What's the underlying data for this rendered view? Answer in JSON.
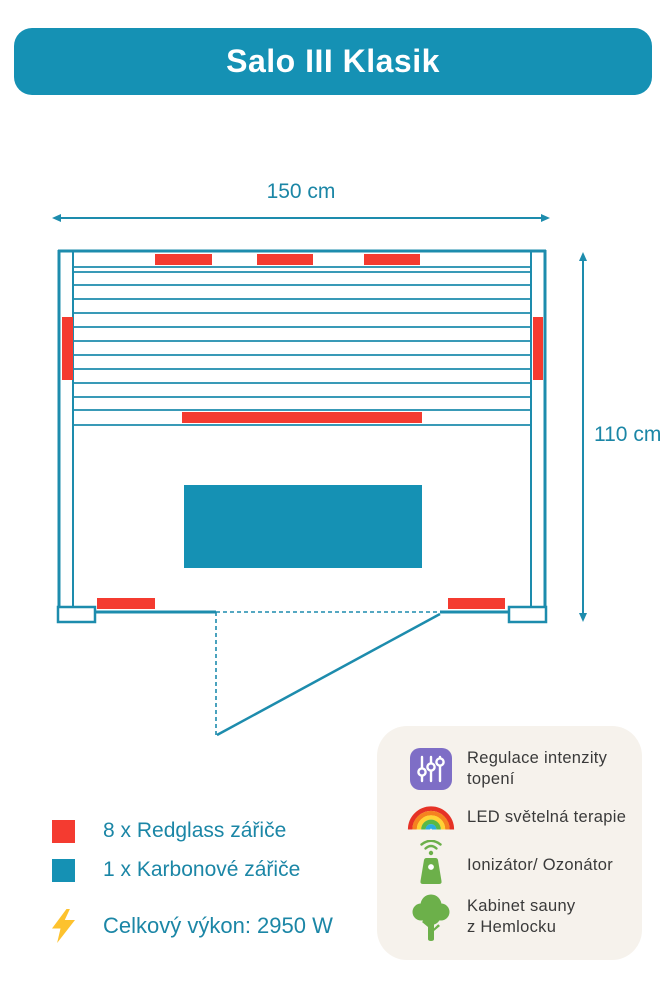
{
  "header": {
    "title": "Salo III Klasik"
  },
  "diagram": {
    "width_label": "150 cm",
    "height_label": "110 cm"
  },
  "legend": {
    "items": [
      {
        "icon": "redglass-swatch",
        "color_key": "red",
        "label": "8 x Redglass zářiče"
      },
      {
        "icon": "karbon-swatch",
        "color_key": "teal",
        "label": "1 x Karbonové zářiče"
      }
    ],
    "power_label": "Celkový výkon: 2950 W"
  },
  "features": {
    "items": [
      {
        "icon": "sliders-icon",
        "lines": [
          "Regulace intenzity",
          "topení"
        ]
      },
      {
        "icon": "rainbow-icon",
        "lines": [
          "LED světelná terapie"
        ]
      },
      {
        "icon": "ionizer-icon",
        "lines": [
          "Ionizátor/ Ozonátor"
        ]
      },
      {
        "icon": "tree-icon",
        "lines": [
          "Kabinet sauny",
          "z Hemlocku"
        ]
      }
    ]
  },
  "colors": {
    "teal": "#1591b4",
    "teal_stroke": "#1d8cad",
    "red": "#f43b30",
    "yellow": "#fdc22e",
    "purple": "#7e6ec6",
    "green": "#6cb04a",
    "panel_bg": "#f6f2ec",
    "text_dark": "#3a3a3a",
    "dim_text": "#1b86a6"
  }
}
